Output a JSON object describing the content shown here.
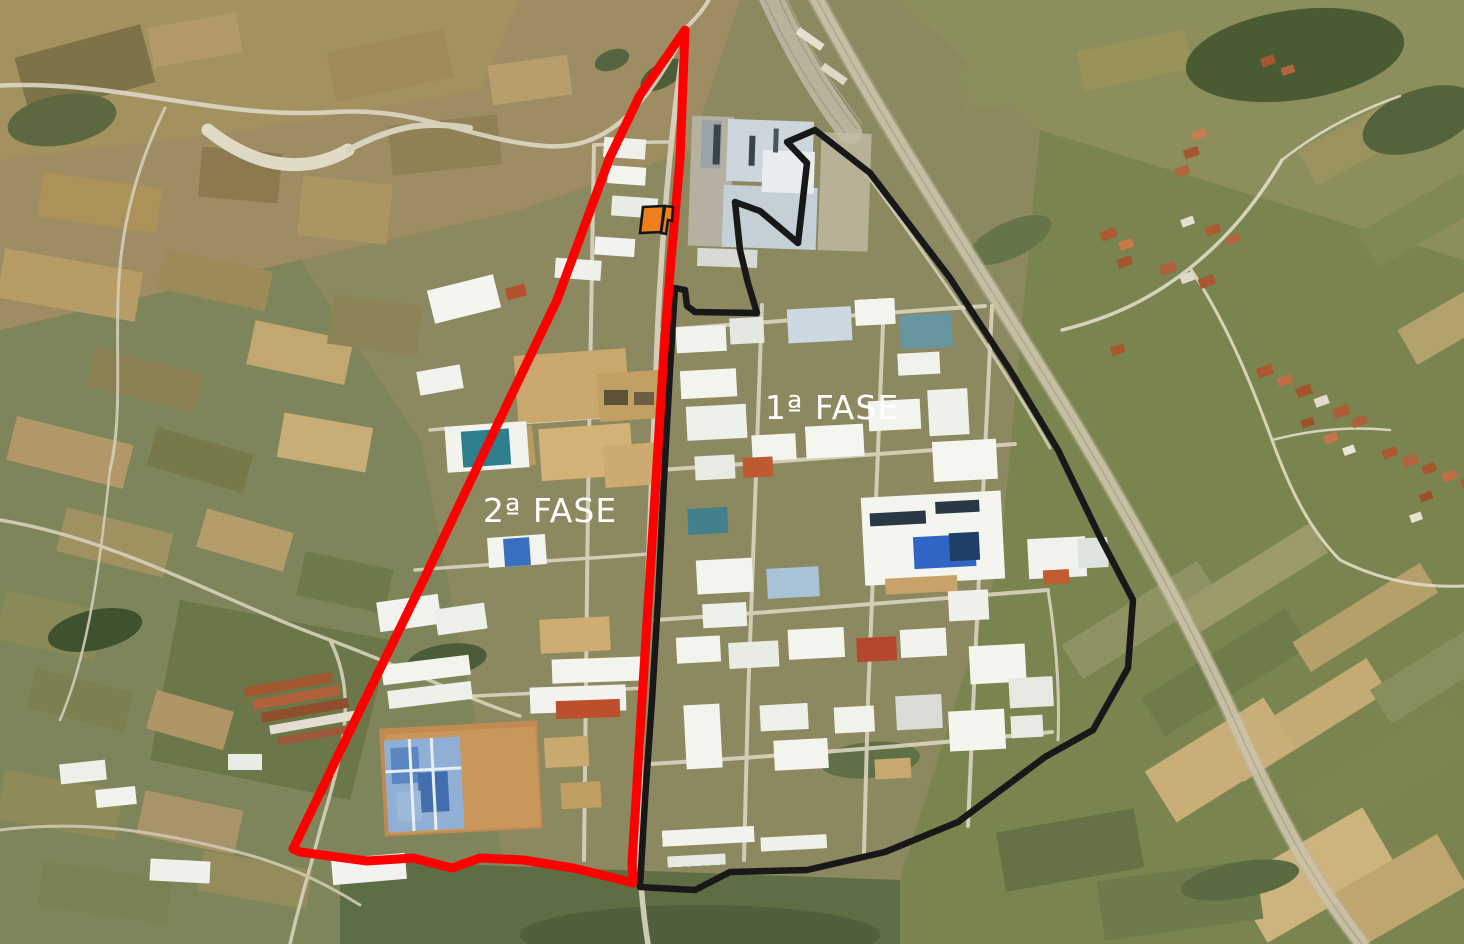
{
  "annotations": {
    "labels_color": "#ffffff",
    "phase1": {
      "label": "1ª FASE",
      "color": "#181818",
      "points": "815,130 870,173 950,278 1010,370 1058,450 1100,537 1133,600 1128,668 1093,730 1045,757 958,822 885,852 807,870 730,872 695,890 640,887 645,800 652,700 658,600 664,480 670,370 675,288 685,290 687,306 695,312 757,313 748,283 740,250 735,202 760,211 798,243 807,163 787,142"
    },
    "phase2": {
      "label": "2ª FASE",
      "color": "#ff0000",
      "points": "685,30 680,160 671,260 664,350 656,480 649,590 642,700 636,800 632,862 633,883 610,877 573,868 523,860 480,858 452,868 413,858 367,861 300,852 293,849 360,710 425,577 490,440 557,300 610,157 640,95"
    },
    "parcel_marker": {
      "fill": "#ee7f1a",
      "outline": "#161616",
      "left_points": "643,207 664,206 661,232 640,233",
      "right_points": "665,206 673,207 672,221 668,220 666,234 661,233"
    }
  }
}
